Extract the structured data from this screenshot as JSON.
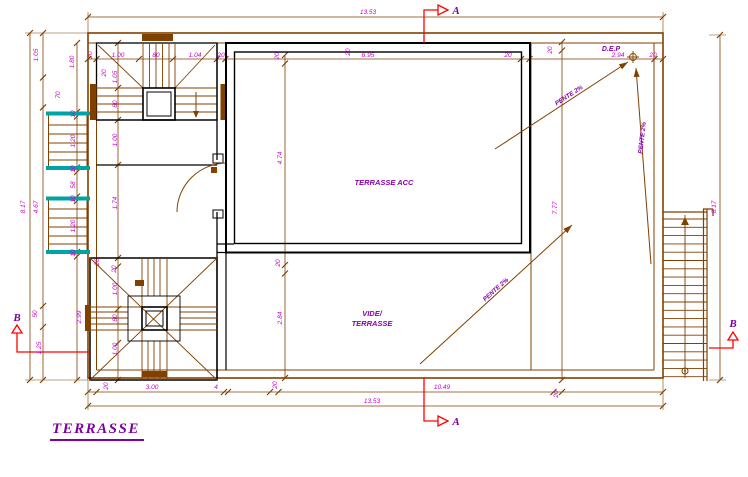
{
  "drawing_title": "TERRASSE",
  "labels": {
    "room_main": "TERRASSE ACC",
    "room_void_line1": "VIDE/",
    "room_void_line2": "TERRASSE",
    "drain": "D.E.P",
    "section_a": "A",
    "section_b": "B"
  },
  "slope_annotations": [
    {
      "text": "PENTE 2%",
      "x": 570,
      "y": 97,
      "rot": -33
    },
    {
      "text": "PENTE 2%",
      "x": 644,
      "y": 138,
      "rot": -83
    },
    {
      "text": "PENTE 2%",
      "x": 497,
      "y": 291,
      "rot": -42
    }
  ],
  "dimensions": [
    {
      "text": "13.53",
      "x": 368,
      "y": 14,
      "rot": 0
    },
    {
      "text": "20",
      "x": 92,
      "y": 55,
      "rot": -90
    },
    {
      "text": "1.00",
      "x": 118,
      "y": 57,
      "rot": 0
    },
    {
      "text": "80",
      "x": 156,
      "y": 57,
      "rot": 0
    },
    {
      "text": "1.04",
      "x": 195,
      "y": 57,
      "rot": 0
    },
    {
      "text": "20",
      "x": 221,
      "y": 57,
      "rot": 0
    },
    {
      "text": "6.95",
      "x": 368,
      "y": 57,
      "rot": 0
    },
    {
      "text": "20",
      "x": 508,
      "y": 57,
      "rot": 0
    },
    {
      "text": "2.94",
      "x": 618,
      "y": 57,
      "rot": 0
    },
    {
      "text": "20",
      "x": 653,
      "y": 57,
      "rot": 0
    },
    {
      "text": "20",
      "x": 552,
      "y": 50,
      "rot": -90
    },
    {
      "text": "20",
      "x": 350,
      "y": 52,
      "rot": -90
    },
    {
      "text": "20",
      "x": 279,
      "y": 56,
      "rot": -90
    },
    {
      "text": "8.17",
      "x": 25,
      "y": 207,
      "rot": -90
    },
    {
      "text": "4.67",
      "x": 38,
      "y": 207,
      "rot": -90
    },
    {
      "text": "1.05",
      "x": 38,
      "y": 55,
      "rot": -90
    },
    {
      "text": "70",
      "x": 60,
      "y": 95,
      "rot": -90
    },
    {
      "text": "50",
      "x": 37,
      "y": 314,
      "rot": -90
    },
    {
      "text": "1.25",
      "x": 41,
      "y": 348,
      "rot": -90
    },
    {
      "text": "1.80",
      "x": 74,
      "y": 62,
      "rot": -90
    },
    {
      "text": "10",
      "x": 75,
      "y": 114,
      "rot": -90
    },
    {
      "text": "1.20",
      "x": 75,
      "y": 141,
      "rot": -90
    },
    {
      "text": "10",
      "x": 75,
      "y": 169,
      "rot": -90
    },
    {
      "text": "58",
      "x": 75,
      "y": 185,
      "rot": -90
    },
    {
      "text": "10",
      "x": 75,
      "y": 199,
      "rot": -90
    },
    {
      "text": "1.20",
      "x": 75,
      "y": 226,
      "rot": -90
    },
    {
      "text": "10",
      "x": 75,
      "y": 253,
      "rot": -90
    },
    {
      "text": "20",
      "x": 106,
      "y": 73,
      "rot": -90
    },
    {
      "text": "1.05",
      "x": 117,
      "y": 77,
      "rot": -90
    },
    {
      "text": "80",
      "x": 117,
      "y": 104,
      "rot": -90
    },
    {
      "text": "1.00",
      "x": 117,
      "y": 140,
      "rot": -90
    },
    {
      "text": "1.74",
      "x": 117,
      "y": 203,
      "rot": -90
    },
    {
      "text": "20",
      "x": 99,
      "y": 262,
      "rot": -90
    },
    {
      "text": "4.74",
      "x": 282,
      "y": 158,
      "rot": -90
    },
    {
      "text": "20",
      "x": 280,
      "y": 263,
      "rot": -90
    },
    {
      "text": "2.84",
      "x": 282,
      "y": 318,
      "rot": -90
    },
    {
      "text": "7.77",
      "x": 557,
      "y": 208,
      "rot": -90
    },
    {
      "text": "8.17",
      "x": 716,
      "y": 207,
      "rot": -90
    },
    {
      "text": "2.99",
      "x": 81,
      "y": 317,
      "rot": -90
    },
    {
      "text": "20",
      "x": 116,
      "y": 269,
      "rot": -90
    },
    {
      "text": "1.00",
      "x": 117,
      "y": 289,
      "rot": -90
    },
    {
      "text": "80",
      "x": 117,
      "y": 318,
      "rot": -90
    },
    {
      "text": "1.00",
      "x": 117,
      "y": 349,
      "rot": -90
    },
    {
      "text": "20",
      "x": 108,
      "y": 386,
      "rot": -90
    },
    {
      "text": "3.00",
      "x": 152,
      "y": 389,
      "rot": 0
    },
    {
      "text": "4",
      "x": 216,
      "y": 389,
      "rot": 0
    },
    {
      "text": "20",
      "x": 277,
      "y": 385,
      "rot": -90
    },
    {
      "text": "10.49",
      "x": 442,
      "y": 389,
      "rot": 0
    },
    {
      "text": "20",
      "x": 558,
      "y": 394,
      "rot": -90
    },
    {
      "text": "13.53",
      "x": 372,
      "y": 403,
      "rot": 0
    }
  ],
  "colors": {
    "walls": "#000000",
    "linework": "#804000",
    "dimension_text": "#C800C8",
    "annotation_text": "#8800AA",
    "section_marks": "#FF0000",
    "window": "#00A3A3"
  }
}
